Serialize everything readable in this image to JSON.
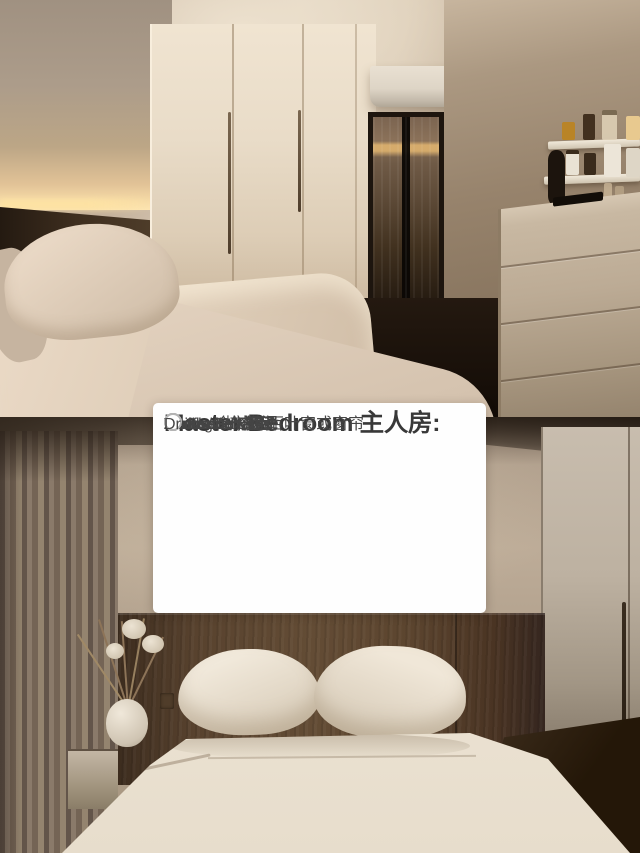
{
  "checklist": {
    "title": "Master Bedroom 主人房:",
    "items": [
      {
        "label": "Mattress 床褥",
        "checked": false
      },
      {
        "label": "Bedframe 床架",
        "checked": false
      },
      {
        "label": "Ceiling fan 风扇",
        "checked": false
      },
      {
        "label": "Aircon 冷气空调",
        "checked": false
      },
      {
        "label": "Blinds/Curtain 百叶窗或窗帘",
        "checked": false
      },
      {
        "label": "Wardrobe 衣柜*",
        "checked": false
      },
      {
        "label": "Dresser 梳妆台*",
        "checked": false
      }
    ]
  },
  "colors": {
    "card-bg": "#fefefe",
    "title-color": "#383838",
    "item-color": "#454545",
    "circle-border": "#b3b3b3"
  }
}
